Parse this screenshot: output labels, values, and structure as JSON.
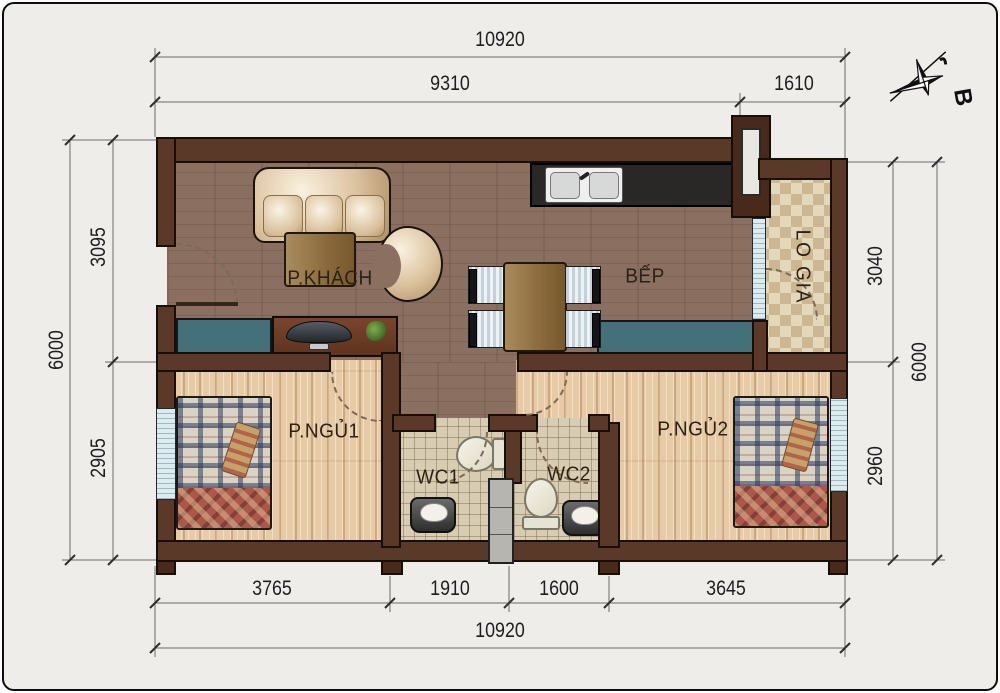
{
  "compass": {
    "label": "B"
  },
  "rooms": {
    "living": "P.KHÁCH",
    "kitchen": "BẾP",
    "loggia": "LO GIA",
    "bedroom1": "P.NGỦ1",
    "bedroom2": "P.NGỦ2",
    "wc1": "WC1",
    "wc2": "WC2"
  },
  "dimensions": {
    "top_total": "10920",
    "top_segments": [
      "9310",
      "1610"
    ],
    "bottom_segments": [
      "3765",
      "1910",
      "1600",
      "3645"
    ],
    "bottom_total": "10920",
    "left_total": "6000",
    "left_segments": [
      "3095",
      "2905"
    ],
    "right_segments": [
      "3040",
      "2960"
    ],
    "right_total": "6000"
  },
  "colors": {
    "wall": "#5b3929",
    "floor_living": "#8b6f60",
    "floor_bedroom": "#e6cba6",
    "floor_wc_tile": "#d8ccb2",
    "floor_loggia": "#cbb791",
    "cabinet_teal": "#44707a",
    "counter": "#2a2727",
    "dimension_text": "#1e1e1e",
    "background": "#efedea"
  }
}
